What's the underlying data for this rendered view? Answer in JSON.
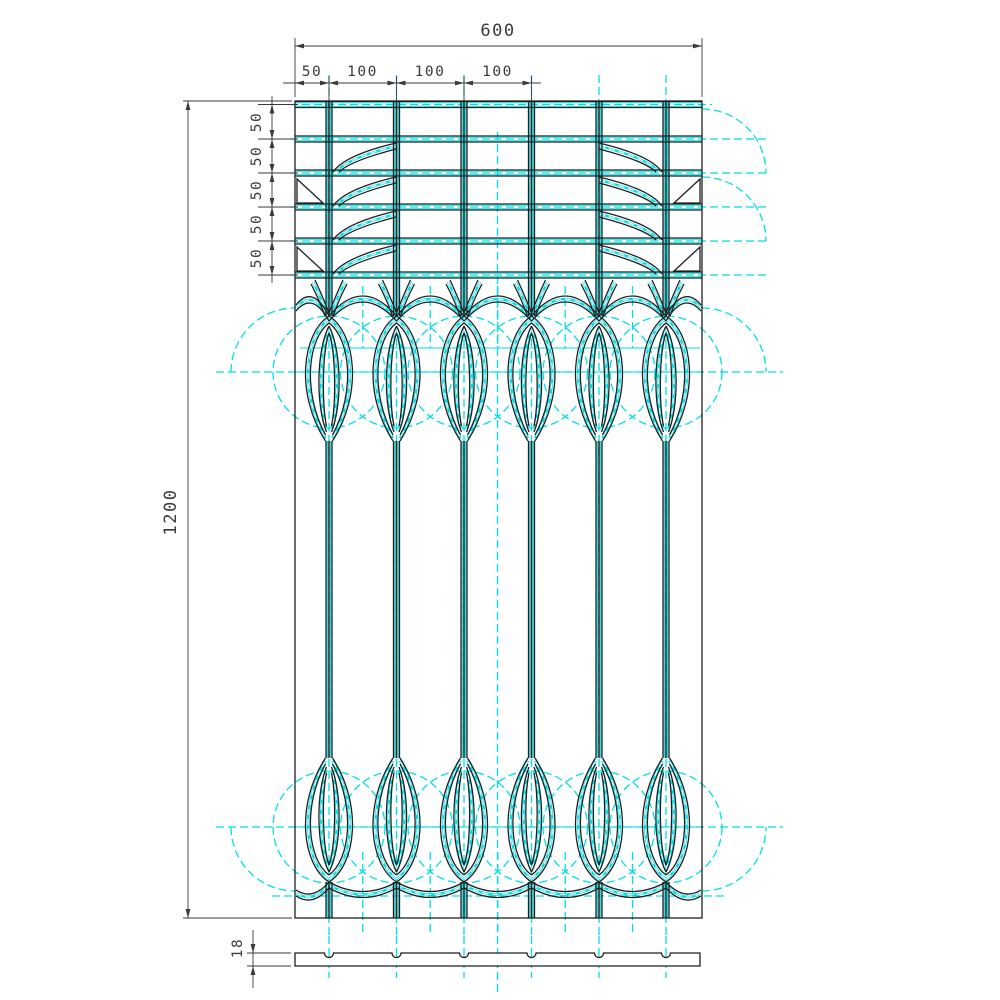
{
  "dimensions": {
    "overall_width": "600",
    "top_chain": [
      "50",
      "100",
      "100",
      "100"
    ],
    "left_chain": [
      "50",
      "50",
      "50",
      "50",
      "50"
    ],
    "overall_height": "1200",
    "section_thickness": "18"
  },
  "colors": {
    "line": "#1f1f1f",
    "construction": "#00dfe6",
    "dimension": "#3a3a3a",
    "background": "#ffffff"
  },
  "layout": {
    "panel": {
      "x": 295,
      "y": 101,
      "w": 407,
      "h": 817
    },
    "balusters_x": [
      329,
      396.5,
      464,
      531.5,
      599,
      666
    ],
    "grid_bars_y": [
      104.5,
      139,
      173,
      207,
      241,
      275
    ],
    "top_loop": {
      "point_y": 316,
      "stem_y": 441,
      "center_y": 372
    },
    "bottom_loop": {
      "point_y": 882,
      "stem_y": 758,
      "center_y": 827
    },
    "loop_circle_r": 56,
    "corner_arc_r": 64,
    "center_x": 497.5,
    "section": {
      "x": 295,
      "y": 953,
      "w": 405,
      "h": 13,
      "notch_r": 4.5
    },
    "notch_count": 6
  }
}
